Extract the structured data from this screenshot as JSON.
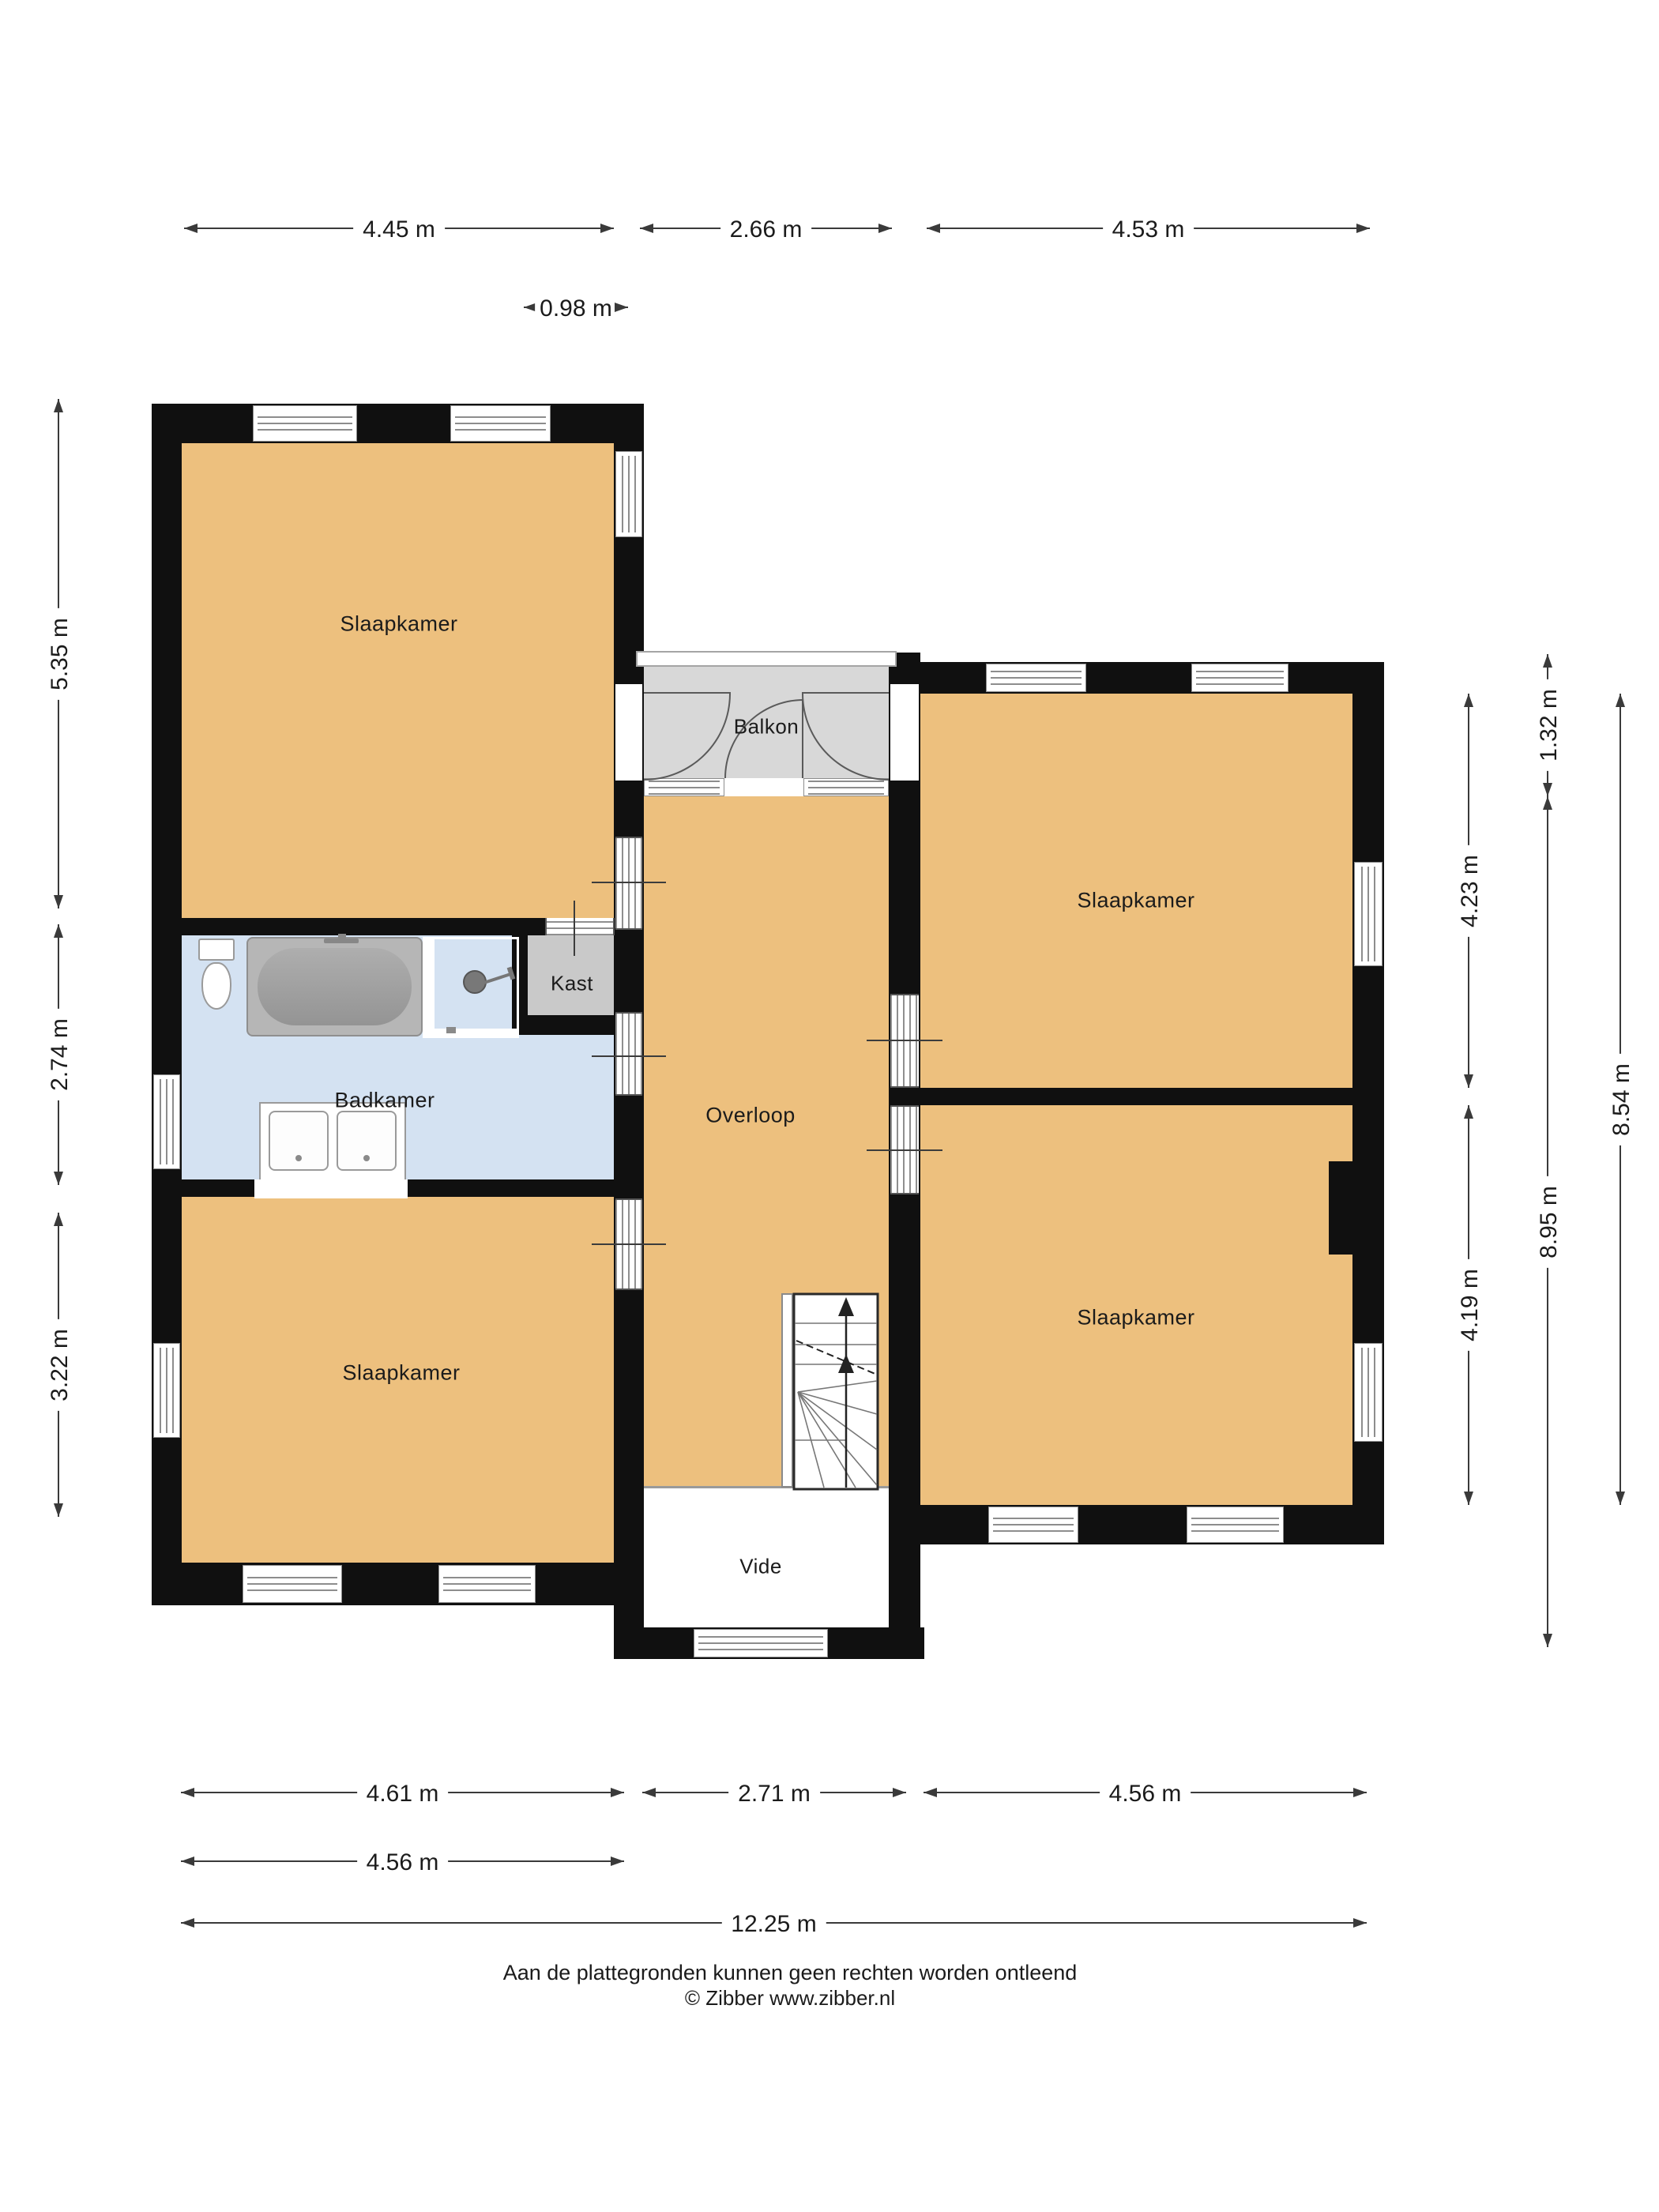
{
  "rooms": {
    "slaapkamer": "Slaapkamer",
    "badkamer": "Badkamer",
    "overloop": "Overloop",
    "balkon": "Balkon",
    "kast": "Kast",
    "vide": "Vide"
  },
  "dimensions": {
    "top": [
      "4.45 m",
      "2.66 m",
      "4.53 m"
    ],
    "kast_width": "0.98 m",
    "left": [
      "5.35 m",
      "2.74 m",
      "3.22 m"
    ],
    "right_rooms": [
      "4.23 m",
      "4.19 m"
    ],
    "balcony_height": "1.32 m",
    "middle_total": "8.95 m",
    "right_total": "8.54 m",
    "bottom": [
      "4.61 m",
      "2.71 m",
      "4.56 m"
    ],
    "bottom_left_inner": "4.56 m",
    "total_width": "12.25 m"
  },
  "footer": {
    "line1": "Aan de plattegronden kunnen geen rechten worden ontleend",
    "line2": "© Zibber www.zibber.nl"
  },
  "colors": {
    "wall": "#101010",
    "floor": "#edc07e",
    "bath": "#d4e2f2",
    "balcony": "#d8d8d8",
    "closet": "#c9c9c9",
    "line": "#3a3a3a"
  }
}
